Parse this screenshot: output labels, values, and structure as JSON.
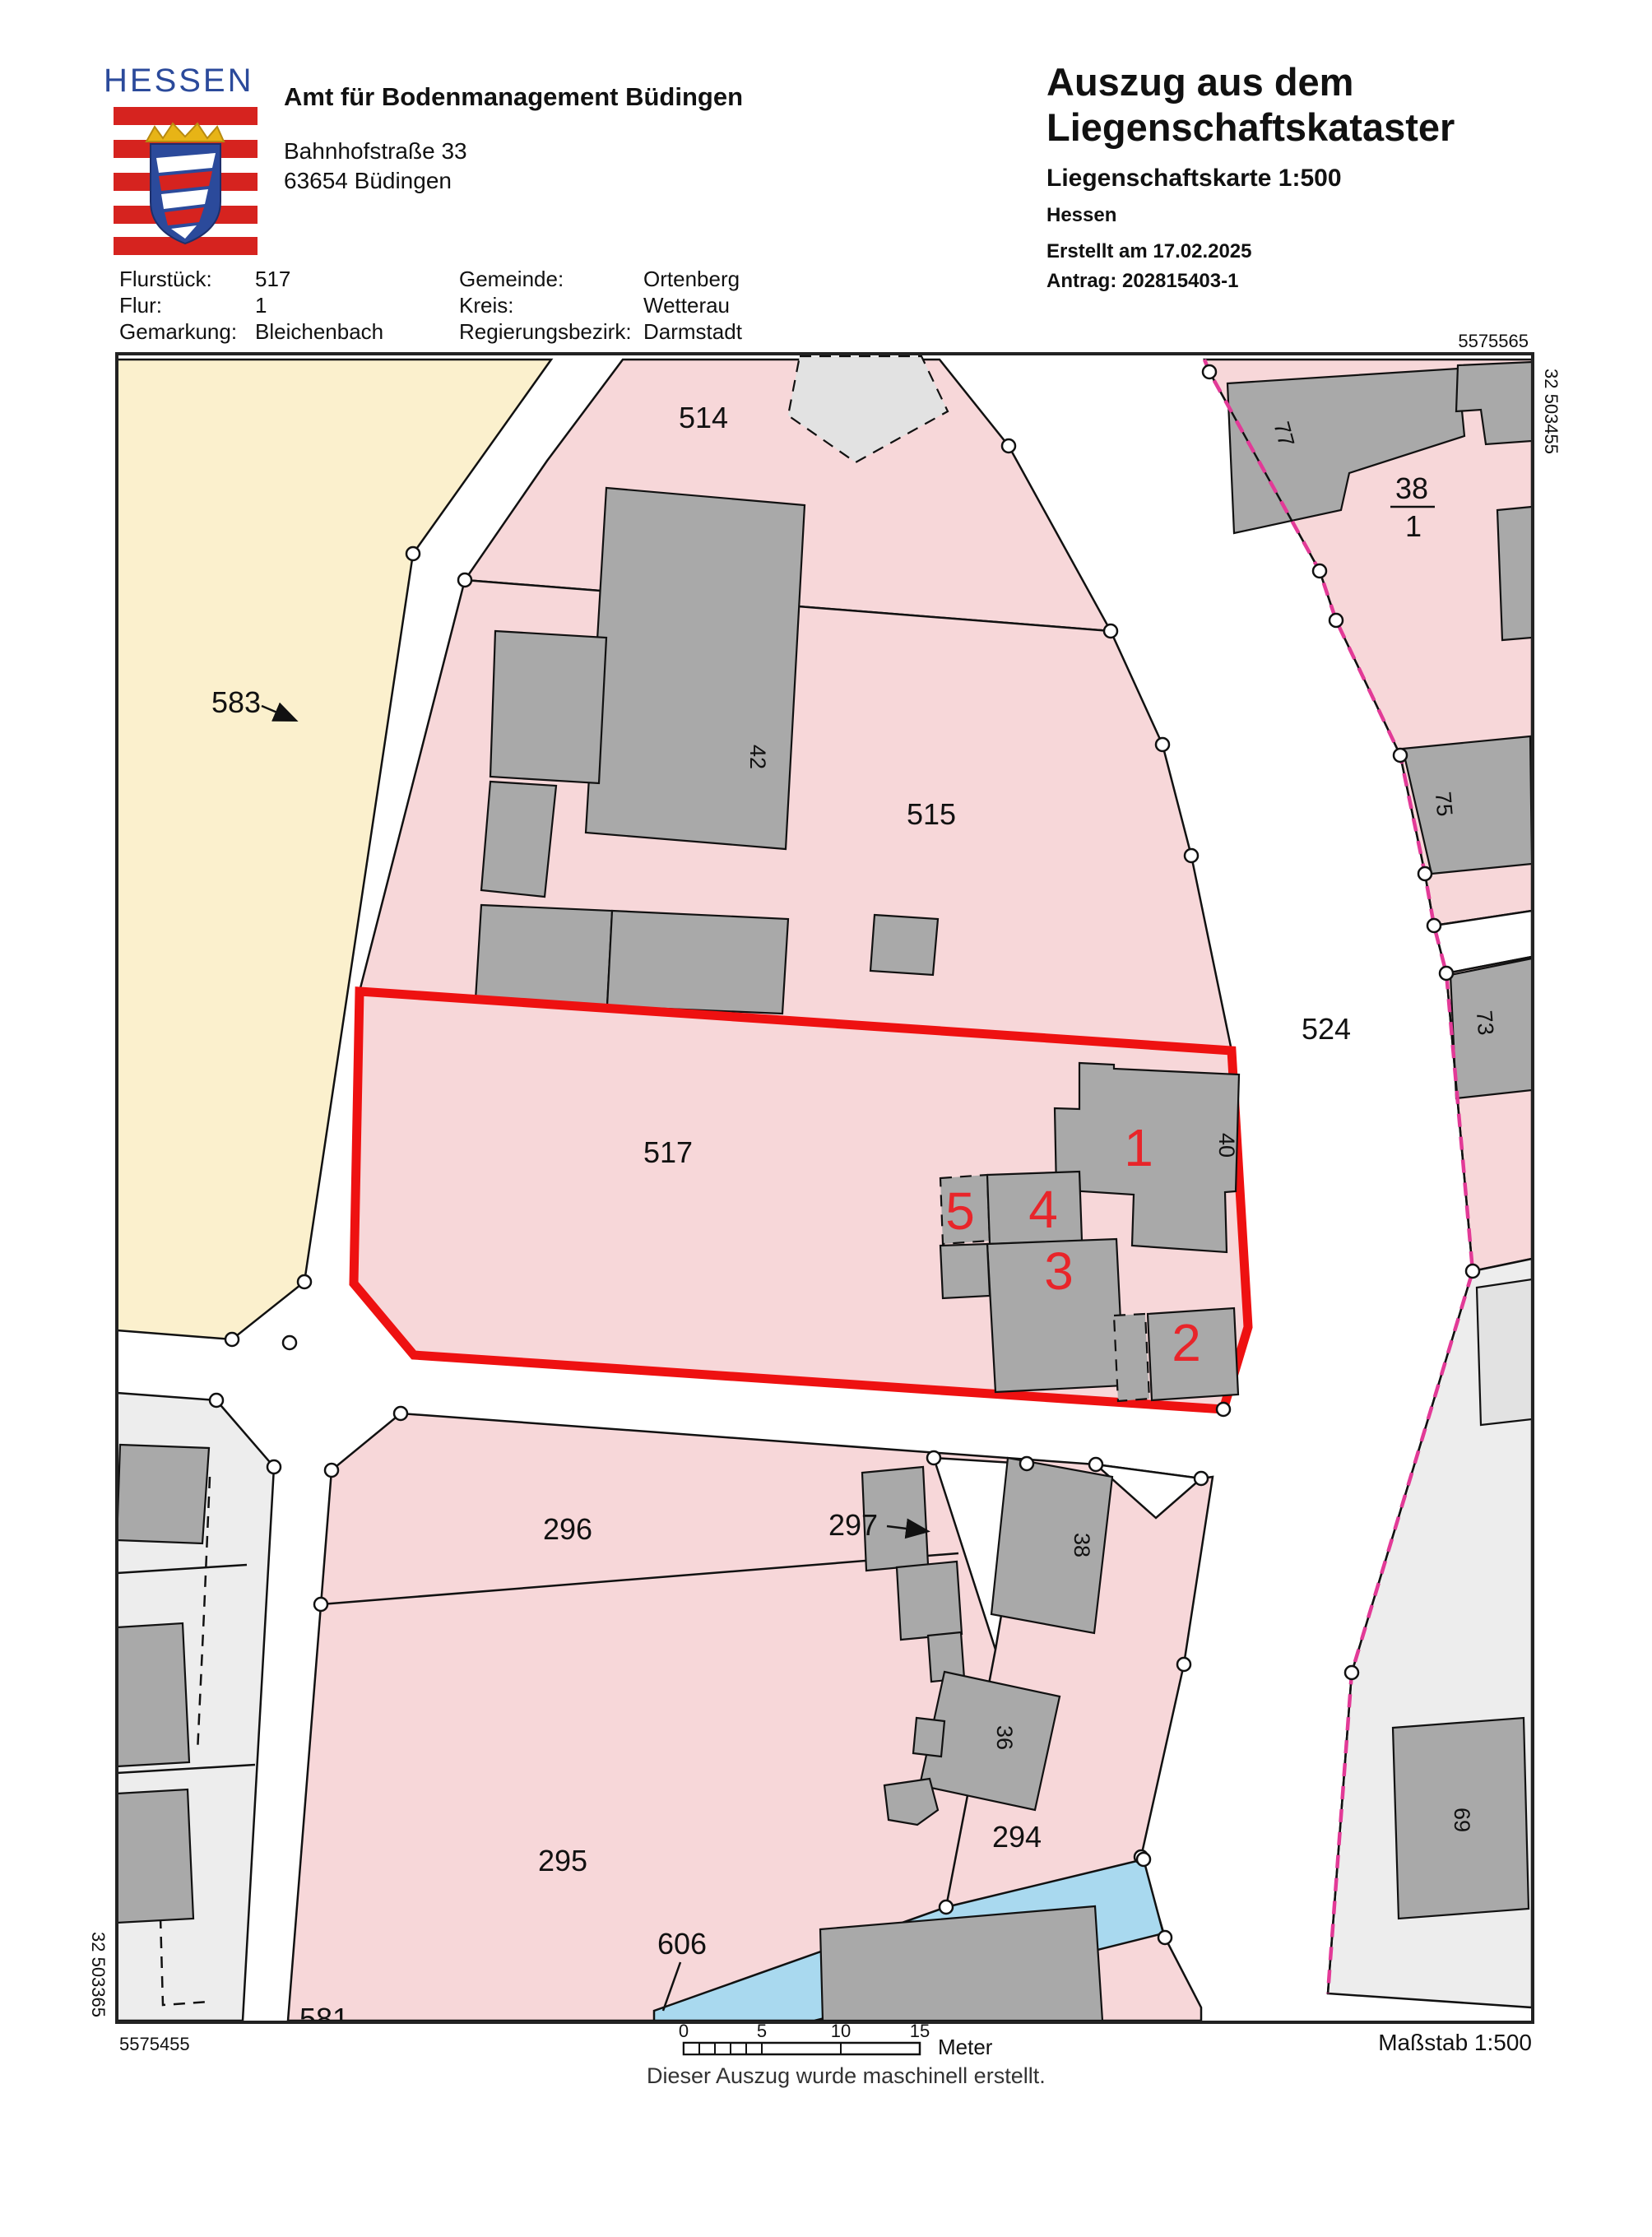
{
  "colors": {
    "logo-blue": "#2b4a9b",
    "logo-red": "#d6231f",
    "parcel-pink": "#f7d7d9",
    "parcel-yellow": "#fbf0cd",
    "building-gray": "#a9a9a9",
    "building-light": "#e2e2e2",
    "area-light": "#ededed",
    "water-blue": "#a9d9ef",
    "highlight-red": "#ee1111",
    "mark-red": "#e8252a",
    "magenta": "#e23a97"
  },
  "header": {
    "logo_word": "HESSEN",
    "agency": "Amt für Bodenmanagement Büdingen",
    "address_line1": "Bahnhofstraße 33",
    "address_line2": "63654 Büdingen"
  },
  "title_block": {
    "title_line1": "Auszug aus dem",
    "title_line2": "Liegenschaftskataster",
    "subtitle": "Liegenschaftskarte 1:500",
    "region": "Hessen",
    "created": "Erstellt am 17.02.2025",
    "antrag": "Antrag: 202815403-1"
  },
  "info": {
    "flurstueck_label": "Flurstück:",
    "flurstueck_value": "517",
    "flur_label": "Flur:",
    "flur_value": "1",
    "gemarkung_label": "Gemarkung:",
    "gemarkung_value": "Bleichenbach",
    "gemeinde_label": "Gemeinde:",
    "gemeinde_value": "Ortenberg",
    "kreis_label": "Kreis:",
    "kreis_value": "Wetterau",
    "regbez_label": "Regierungsbezirk:",
    "regbez_value": "Darmstadt"
  },
  "map": {
    "corner_labels": {
      "north_east": "5575565",
      "east_vertical": "32 503455",
      "west_vertical": "32 503365",
      "south_west": "5575455"
    },
    "scale_text": "Maßstab 1:500",
    "footer_note": "Dieser Auszug wurde maschinell erstellt.",
    "scale_bar": {
      "t0": "0",
      "t1": "5",
      "t2": "10",
      "t3": "15",
      "unit": "Meter"
    },
    "parcel_labels": {
      "p583": "583",
      "p514": "514",
      "p515": "515",
      "p517": "517",
      "p524": "524",
      "p296": "296",
      "p297": "297",
      "p295": "295",
      "p294": "294",
      "p606": "606",
      "p581": "581",
      "f38_num": "38",
      "f38_den": "1"
    },
    "house_numbers": {
      "h42": "42",
      "h40": "40",
      "h77": "77",
      "h75": "75",
      "h73": "73",
      "h38": "38",
      "h36": "36",
      "h69": "69"
    },
    "red_marks": {
      "m1": "1",
      "m2": "2",
      "m3": "3",
      "m4": "4",
      "m5": "5"
    }
  }
}
